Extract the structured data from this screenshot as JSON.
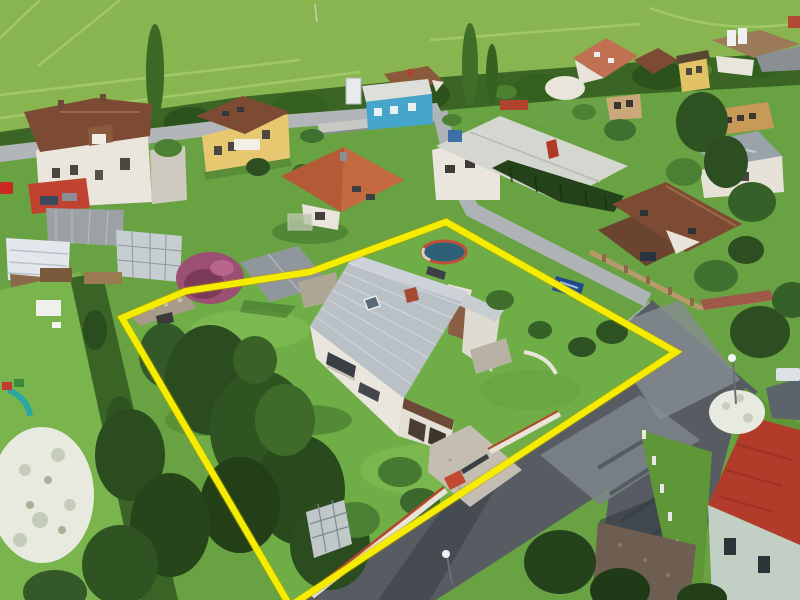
{
  "meta": {
    "kind": "aerial drone photograph",
    "subject": "suburban family house plot highlighted with yellow boundary outline",
    "setting": "village street with houses, gardens, roads and a green field"
  },
  "colors": {
    "base_green": "#69a243",
    "field": "#88b550",
    "field_streak": "#a9cc6e",
    "treeline": "#3a6524",
    "road_light": "#b3b6b9",
    "road_dark": "#565c62",
    "road_patch": "#7d848b",
    "lawn": "#6fae47",
    "lawn_bright": "#79b44c",
    "lawn_shadow": "#3c6e28",
    "conifer": "#2b4c1e",
    "tree_green": "#4c8032",
    "blossom": "#e8e9df",
    "purple_tree": "#9a4f73",
    "roof_brown": "#7d4b33",
    "roof_orange": "#b45a36",
    "roof_salmon": "#c27052",
    "roof_gray": "#b9c0c6",
    "roof_red": "#b23b2a",
    "wall_white": "#eae6dd",
    "wall_yellow": "#e7c76f",
    "wall_blue": "#45a5cb",
    "building_wall": "#c2cfc4",
    "gravel": "#c4beb2",
    "gravel_brown": "#6d5e51",
    "glass": "#c7ced2",
    "boundary": "#f6ec00"
  },
  "boundary": {
    "points": "122,318 186,291 310,272 446,222 676,352 290,606"
  }
}
